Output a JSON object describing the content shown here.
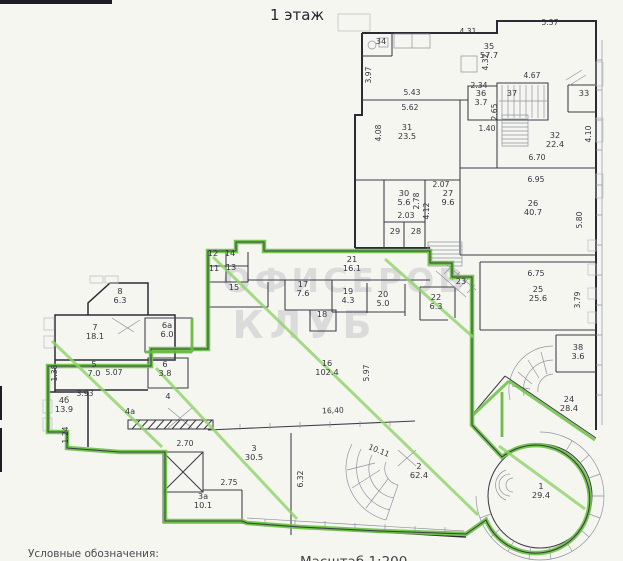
{
  "page": {
    "title": "1 этаж",
    "legend_label": "Условные обозначения:",
    "scale_label": "Масштаб 1:200",
    "watermark": {
      "line1": "ОФИСЕРОВ",
      "line2": "КЛУБ"
    }
  },
  "colors": {
    "paper": "#f6f6f1",
    "wall": "#2b2b35",
    "green": "#69c241",
    "green_hatch": "#8fd368",
    "text": "#343440"
  },
  "rooms": [
    {
      "num": "1",
      "area": "29.4",
      "x": 541,
      "y": 489
    },
    {
      "num": "2",
      "area": "62.4",
      "x": 419,
      "y": 469
    },
    {
      "num": "3",
      "area": "30.5",
      "x": 254,
      "y": 451
    },
    {
      "num": "3а",
      "area": "10.1",
      "x": 203,
      "y": 499
    },
    {
      "num": "4",
      "area": "",
      "x": 168,
      "y": 399
    },
    {
      "num": "4а",
      "area": "",
      "x": 130,
      "y": 414
    },
    {
      "num": "4б",
      "area": "13.9",
      "x": 64,
      "y": 403
    },
    {
      "num": "5",
      "area": "7.0",
      "x": 94,
      "y": 367
    },
    {
      "num": "6",
      "area": "3.8",
      "x": 165,
      "y": 367
    },
    {
      "num": "6а",
      "area": "6.0",
      "x": 167,
      "y": 328
    },
    {
      "num": "7",
      "area": "18.1",
      "x": 95,
      "y": 330
    },
    {
      "num": "8",
      "area": "6.3",
      "x": 120,
      "y": 294
    },
    {
      "num": "11",
      "area": "",
      "x": 214,
      "y": 271
    },
    {
      "num": "12",
      "area": "",
      "x": 213,
      "y": 256
    },
    {
      "num": "13",
      "area": "",
      "x": 231,
      "y": 270
    },
    {
      "num": "14",
      "area": "",
      "x": 230,
      "y": 256
    },
    {
      "num": "15",
      "area": "",
      "x": 234,
      "y": 290
    },
    {
      "num": "16",
      "area": "102.4",
      "x": 327,
      "y": 366
    },
    {
      "num": "17",
      "area": "7.6",
      "x": 303,
      "y": 287
    },
    {
      "num": "18",
      "area": "",
      "x": 322,
      "y": 317
    },
    {
      "num": "19",
      "area": "4.3",
      "x": 348,
      "y": 294
    },
    {
      "num": "20",
      "area": "5.0",
      "x": 383,
      "y": 297
    },
    {
      "num": "21",
      "area": "16.1",
      "x": 352,
      "y": 262
    },
    {
      "num": "22",
      "area": "6.3",
      "x": 436,
      "y": 300
    },
    {
      "num": "23",
      "area": "",
      "x": 461,
      "y": 284
    },
    {
      "num": "24",
      "area": "28.4",
      "x": 569,
      "y": 402
    },
    {
      "num": "25",
      "area": "25.6",
      "x": 538,
      "y": 292
    },
    {
      "num": "26",
      "area": "40.7",
      "x": 533,
      "y": 206
    },
    {
      "num": "27",
      "area": "9.6",
      "x": 448,
      "y": 196
    },
    {
      "num": "28",
      "area": "",
      "x": 416,
      "y": 234
    },
    {
      "num": "29",
      "area": "",
      "x": 395,
      "y": 234
    },
    {
      "num": "30",
      "area": "5.6",
      "x": 404,
      "y": 196
    },
    {
      "num": "31",
      "area": "23.5",
      "x": 407,
      "y": 130
    },
    {
      "num": "32",
      "area": "22.4",
      "x": 555,
      "y": 138
    },
    {
      "num": "33",
      "area": "",
      "x": 584,
      "y": 96
    },
    {
      "num": "34",
      "area": "",
      "x": 381,
      "y": 44
    },
    {
      "num": "35",
      "area": "57.7",
      "x": 489,
      "y": 49
    },
    {
      "num": "36",
      "area": "3.7",
      "x": 481,
      "y": 96
    },
    {
      "num": "37",
      "area": "",
      "x": 512,
      "y": 96
    },
    {
      "num": "38",
      "area": "3.6",
      "x": 578,
      "y": 350
    }
  ],
  "dimensions": [
    {
      "text": "5.37",
      "x": 550,
      "y": 25,
      "rot": 0
    },
    {
      "text": "4.31",
      "x": 468,
      "y": 34,
      "rot": 0
    },
    {
      "text": "3.97",
      "x": 371,
      "y": 75,
      "rot": -90
    },
    {
      "text": "4.32",
      "x": 488,
      "y": 62,
      "rot": -90
    },
    {
      "text": "4.67",
      "x": 532,
      "y": 78,
      "rot": 0
    },
    {
      "text": "2.34",
      "x": 479,
      "y": 88,
      "rot": 0
    },
    {
      "text": "5.43",
      "x": 412,
      "y": 95,
      "rot": 0
    },
    {
      "text": "5.62",
      "x": 410,
      "y": 110,
      "rot": 0
    },
    {
      "text": "2.65",
      "x": 497,
      "y": 112,
      "rot": -90
    },
    {
      "text": "1.40",
      "x": 487,
      "y": 131,
      "rot": 0
    },
    {
      "text": "4.08",
      "x": 381,
      "y": 133,
      "rot": -90
    },
    {
      "text": "6.70",
      "x": 537,
      "y": 160,
      "rot": 0
    },
    {
      "text": "4.10",
      "x": 591,
      "y": 134,
      "rot": -90
    },
    {
      "text": "6.95",
      "x": 536,
      "y": 182,
      "rot": 0
    },
    {
      "text": "2.07",
      "x": 441,
      "y": 187,
      "rot": 0
    },
    {
      "text": "2.78",
      "x": 419,
      "y": 201,
      "rot": -90
    },
    {
      "text": "4.12",
      "x": 429,
      "y": 211,
      "rot": -90
    },
    {
      "text": "2.03",
      "x": 406,
      "y": 218,
      "rot": 0
    },
    {
      "text": "5.80",
      "x": 582,
      "y": 220,
      "rot": -90
    },
    {
      "text": "6.75",
      "x": 536,
      "y": 276,
      "rot": 0
    },
    {
      "text": "3.79",
      "x": 580,
      "y": 300,
      "rot": -90
    },
    {
      "text": "5.97",
      "x": 369,
      "y": 373,
      "rot": -90
    },
    {
      "text": "16,40",
      "x": 333,
      "y": 413,
      "rot": -2
    },
    {
      "text": "10.11",
      "x": 378,
      "y": 453,
      "rot": 22
    },
    {
      "text": "6.32",
      "x": 303,
      "y": 479,
      "rot": -90
    },
    {
      "text": "2.70",
      "x": 185,
      "y": 446,
      "rot": 0
    },
    {
      "text": "2.75",
      "x": 229,
      "y": 485,
      "rot": 0
    },
    {
      "text": "5.07",
      "x": 114,
      "y": 375,
      "rot": 0
    },
    {
      "text": "3.93",
      "x": 85,
      "y": 396,
      "rot": 0
    },
    {
      "text": "1.38",
      "x": 57,
      "y": 373,
      "rot": -90
    },
    {
      "text": "1.24",
      "x": 68,
      "y": 435,
      "rot": -90
    }
  ]
}
